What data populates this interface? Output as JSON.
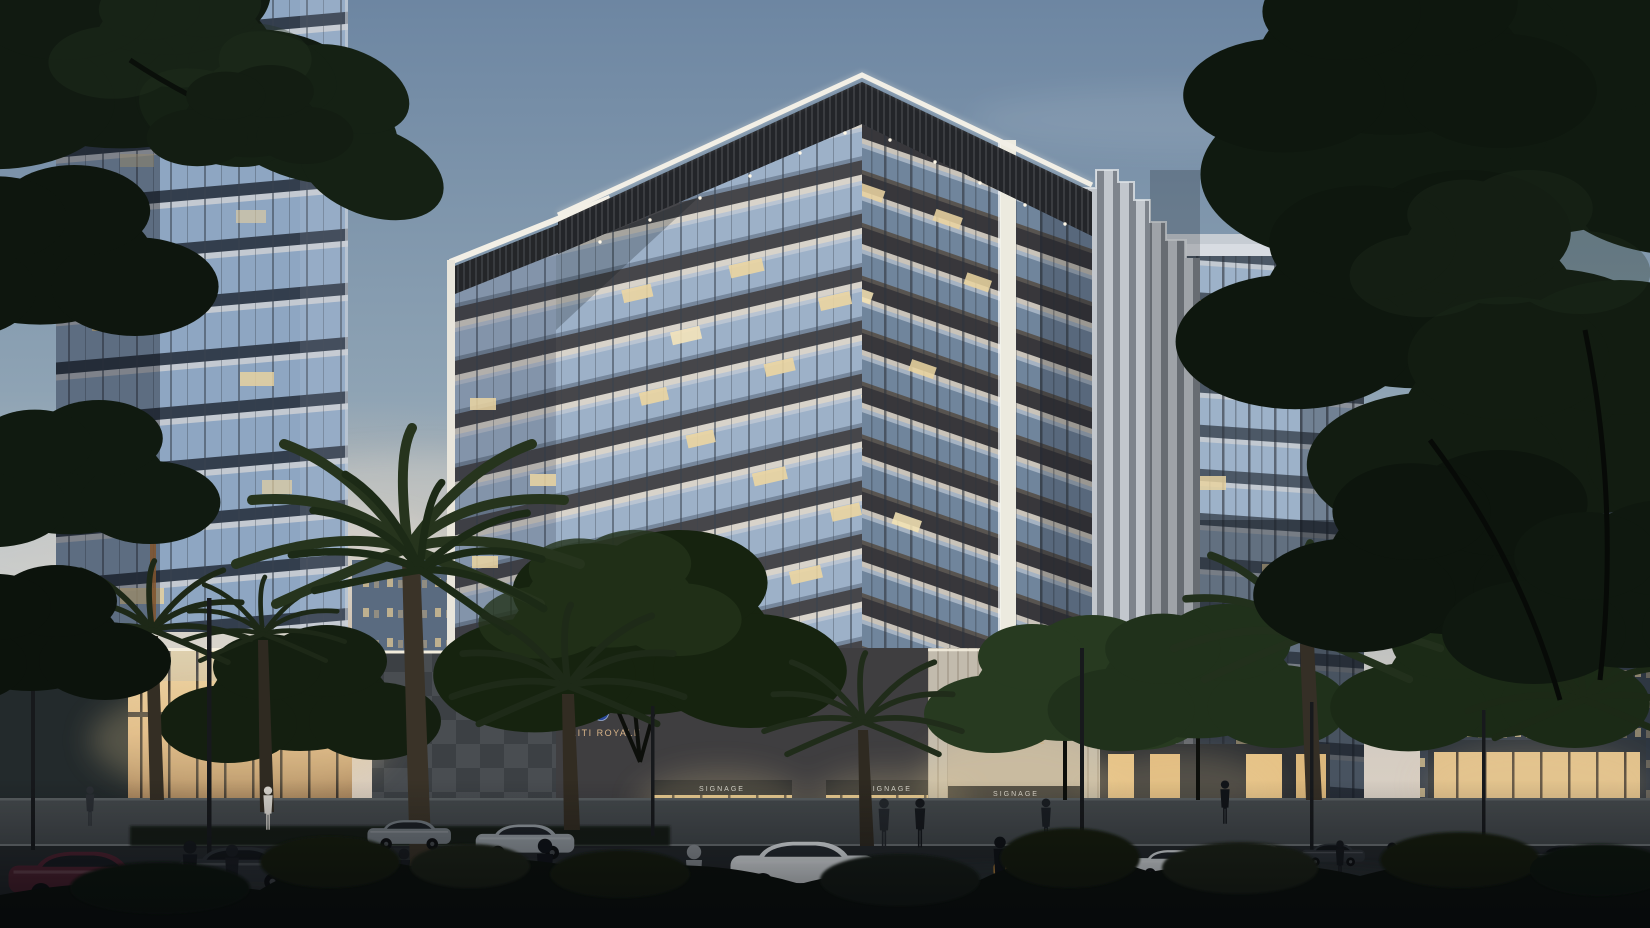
{
  "scene": {
    "description": "Dusk architectural rendering of a modern residential complex: central cream mid-rise with illuminated peaked roof frame and stacked balconies, flanking glass towers, fin-clad building, palm trees, street with parked cars and pedestrians"
  },
  "signs": {
    "brand": {
      "logo_letter": "B",
      "name": "BAITI ROYALE",
      "subtitle": "RESIDENCE"
    },
    "podium": {
      "logo_letter": "B",
      "name": "BAITI ROYALE"
    },
    "storefront_placeholder": "SIGNAGE"
  },
  "colors": {
    "sky_top": "#6d86a2",
    "sky_mid": "#b4bcc0",
    "sky_horizon": "#ded6c9",
    "dusk_glow": "#e8c9a4",
    "building_light": "#d8d3ca",
    "fascia_dark": "#26282c",
    "glass_cool": "#9db1c8",
    "interior_warm": "#e8d2a0",
    "foliage_dark": "#111a11",
    "asphalt": "#25292c",
    "logo_blue": "#2a4a9b",
    "sign_bronze": "#d8b488"
  }
}
